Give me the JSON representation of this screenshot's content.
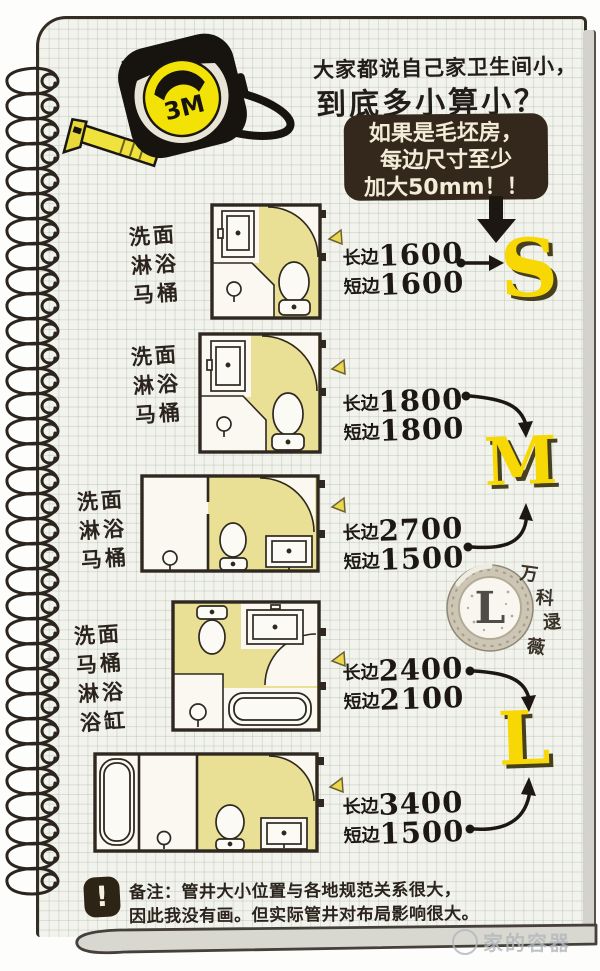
{
  "header": {
    "title_line1": "大家都说自己家卫生间小，",
    "title_line2": "到底多小算小？",
    "tape_label": "3M",
    "bubble_lines": [
      "如果是毛坯房，",
      "每边尺寸至少",
      "加大50mm！！"
    ]
  },
  "plans": [
    {
      "fixtures": [
        "洗面",
        "淋浴",
        "马桶"
      ],
      "long_label": "长边",
      "long_value": "1600",
      "short_label": "短边",
      "short_value": "1600",
      "size": "S"
    },
    {
      "fixtures": [
        "洗面",
        "淋浴",
        "马桶"
      ],
      "long_label": "长边",
      "long_value": "1800",
      "short_label": "短边",
      "short_value": "1800",
      "size": "M"
    },
    {
      "fixtures": [
        "洗面",
        "淋浴",
        "马桶"
      ],
      "long_label": "长边",
      "long_value": "2700",
      "short_label": "短边",
      "short_value": "1500",
      "size": "M"
    },
    {
      "fixtures": [
        "洗面",
        "马桶",
        "淋浴",
        "浴缸"
      ],
      "long_label": "长边",
      "long_value": "2400",
      "short_label": "短边",
      "short_value": "2100",
      "size": "L"
    },
    {
      "fixtures": [],
      "long_label": "长边",
      "long_value": "3400",
      "short_label": "短边",
      "short_value": "1500",
      "size": "L"
    }
  ],
  "size_letters": {
    "small": "S",
    "medium": "M",
    "large": "L"
  },
  "badge": {
    "letter": "L",
    "author_chars": [
      "万",
      "科",
      "逯",
      "薇"
    ]
  },
  "footnote": {
    "icon_mark": "!",
    "line1": "备注：管井大小位置与各地规范关系很大，",
    "line2": "因此我没有画。但实际管井对布局影响很大。"
  },
  "watermark": "家的容器",
  "colors": {
    "accent_yellow": "#f8d804",
    "floor_yellow": "#e9e095",
    "bubble_brown": "#33281b",
    "page_paper": "#f3f3ed",
    "ink": "#221d16"
  }
}
